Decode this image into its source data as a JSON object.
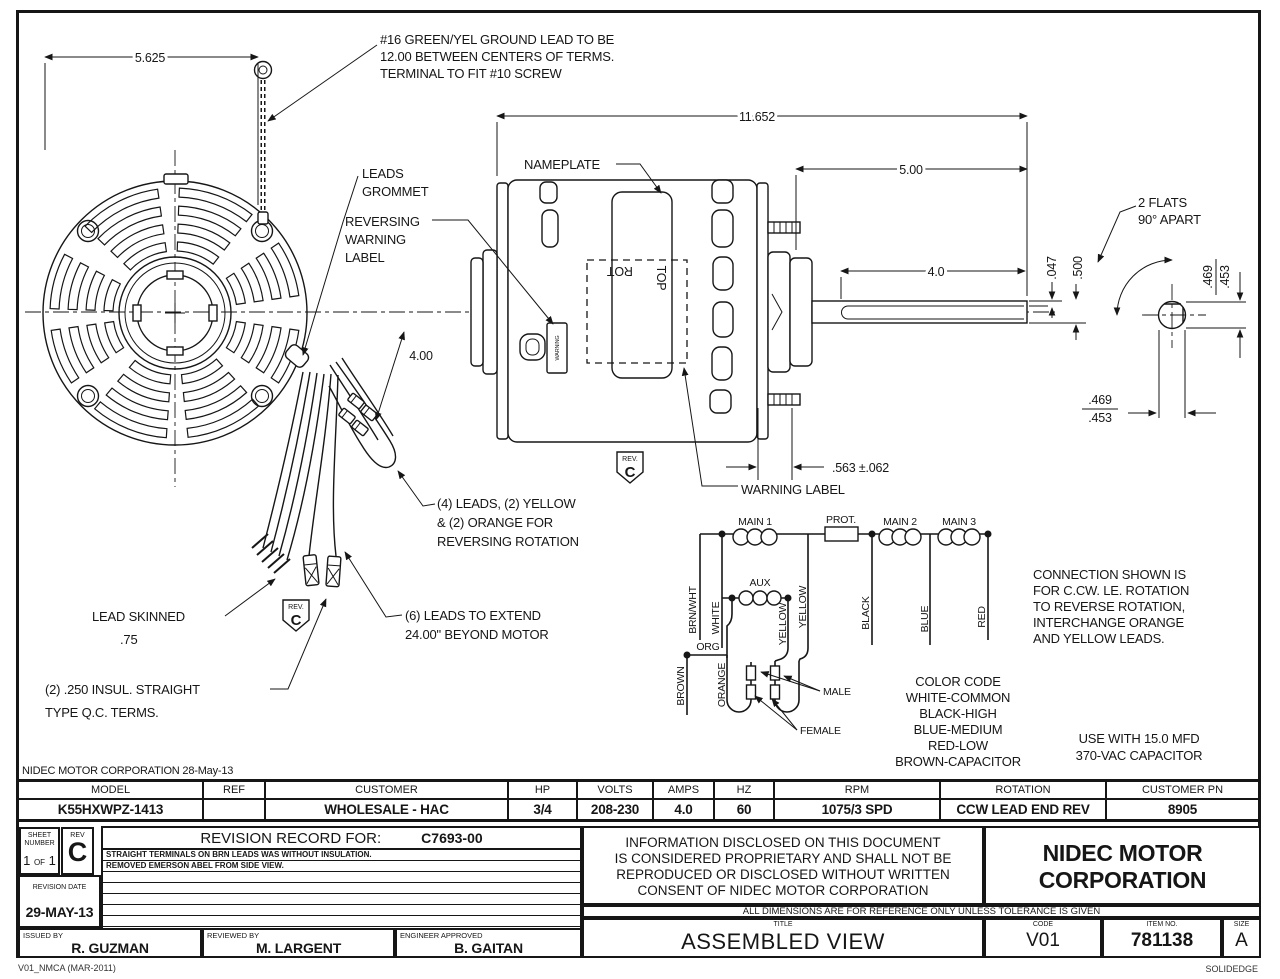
{
  "colors": {
    "ink": "#161616",
    "paper": "#ffffff"
  },
  "stamp": "NIDEC MOTOR CORPORATION 28-May-13",
  "footer": {
    "left": "V01_NMCA (MAR-2011)",
    "right": "SOLIDEDGE"
  },
  "annotations": {
    "ground_note": [
      "#16 GREEN/YEL GROUND LEAD TO BE",
      "12.00 BETWEEN CENTERS OF TERMS.",
      "TERMINAL TO FIT #10 SCREW"
    ],
    "leads_grommet": [
      "LEADS",
      "GROMMET"
    ],
    "reversing_label": [
      "REVERSING",
      "WARNING",
      "LABEL"
    ],
    "nameplate": "NAMEPLATE",
    "warning_label": "WARNING LABEL",
    "two_flats": [
      "2 FLATS",
      "90° APART"
    ],
    "four_leads": [
      "(4) LEADS, (2) YELLOW",
      "& (2) ORANGE FOR",
      "REVERSING ROTATION"
    ],
    "six_leads": [
      "(6) LEADS TO EXTEND",
      "24.00\" BEYOND MOTOR"
    ],
    "lead_skinned": [
      "LEAD SKINNED",
      ".75"
    ],
    "qc_terms": [
      "(2) .250 INSUL. STRAIGHT",
      "TYPE Q.C. TERMS."
    ],
    "connection_note": [
      "CONNECTION SHOWN IS",
      "FOR C.CW. LE. ROTATION",
      "TO REVERSE ROTATION,",
      "INTERCHANGE ORANGE",
      "AND YELLOW LEADS."
    ],
    "color_code": [
      "COLOR CODE",
      "WHITE-COMMON",
      "BLACK-HIGH",
      "BLUE-MEDIUM",
      "RED-LOW",
      "BROWN-CAPACITOR"
    ],
    "capacitor_note": [
      "USE WITH 15.0 MFD",
      "370-VAC CAPACITOR"
    ],
    "rev_flag_small": "REV.",
    "rev_flag_letter": "C",
    "motor_rot": "ROT",
    "motor_top": "TOP",
    "motor_warning": "WARNING"
  },
  "dimensions": {
    "d5625": "5.625",
    "d11652": "11.652",
    "d500": "5.00",
    "d40": "4.0",
    "d400": "4.00",
    "d047": ".047",
    "dhalf": ".500",
    "d469a": ".469",
    "d453a": ".453",
    "d469b": ".469",
    "d453b": ".453",
    "d563": ".563 ±.062"
  },
  "wiring": {
    "main1": "MAIN 1",
    "prot": "PROT.",
    "main2": "MAIN 2",
    "main3": "MAIN 3",
    "aux": "AUX",
    "brnwht": "BRN/WHT",
    "white": "WHITE",
    "yellow1": "YELLOW",
    "yellow2": "YELLOW",
    "black": "BLACK",
    "blue": "BLUE",
    "red": "RED",
    "org": "ORG",
    "brown": "BROWN",
    "orange": "ORANGE",
    "male": "MALE",
    "female": "FEMALE"
  },
  "spec_table": {
    "headers": [
      "MODEL",
      "REF",
      "CUSTOMER",
      "HP",
      "VOLTS",
      "AMPS",
      "HZ",
      "RPM",
      "ROTATION",
      "CUSTOMER PN"
    ],
    "values": [
      "K55HXWPZ-1413",
      "",
      "WHOLESALE - HAC",
      "3/4",
      "208-230",
      "4.0",
      "60",
      "1075/3 SPD",
      "CCW LEAD END REV",
      "8905"
    ]
  },
  "title_block": {
    "sheet_label1": "SHEET",
    "sheet_label2": "NUMBER",
    "sheet_n1": "1",
    "sheet_of": "OF",
    "sheet_n2": "1",
    "rev_label": "REV",
    "rev_value": "C",
    "revision_record_label": "REVISION RECORD FOR:",
    "revision_record_number": "C7693-00",
    "revision_notes": [
      "STRAIGHT TERMINALS ON BRN LEADS WAS WITHOUT INSULATION.",
      "REMOVED EMERSON ABEL FROM SIDE VIEW."
    ],
    "revision_date_label": "REVISION DATE",
    "revision_date": "29-MAY-13",
    "issued_by_label": "ISSUED BY",
    "issued_by": "R. GUZMAN",
    "reviewed_by_label": "REVIEWED BY",
    "reviewed_by": "M. LARGENT",
    "engineer_label": "ENGINEER APPROVED",
    "engineer": "B. GAITAN",
    "proprietary": [
      "INFORMATION DISCLOSED ON THIS DOCUMENT",
      "IS CONSIDERED PROPRIETARY AND SHALL NOT BE",
      "REPRODUCED OR DISCLOSED WITHOUT WRITTEN",
      "CONSENT OF NIDEC MOTOR CORPORATION"
    ],
    "company": [
      "NIDEC MOTOR",
      "CORPORATION"
    ],
    "tolerance_note": "ALL DIMENSIONS ARE FOR REFERENCE ONLY UNLESS TOLERANCE IS GIVEN",
    "title_label": "TITLE",
    "title": "ASSEMBLED VIEW",
    "code_label": "CODE",
    "code": "V01",
    "item_label": "ITEM NO.",
    "item": "781138",
    "size_label": "SIZE",
    "size": "A"
  }
}
